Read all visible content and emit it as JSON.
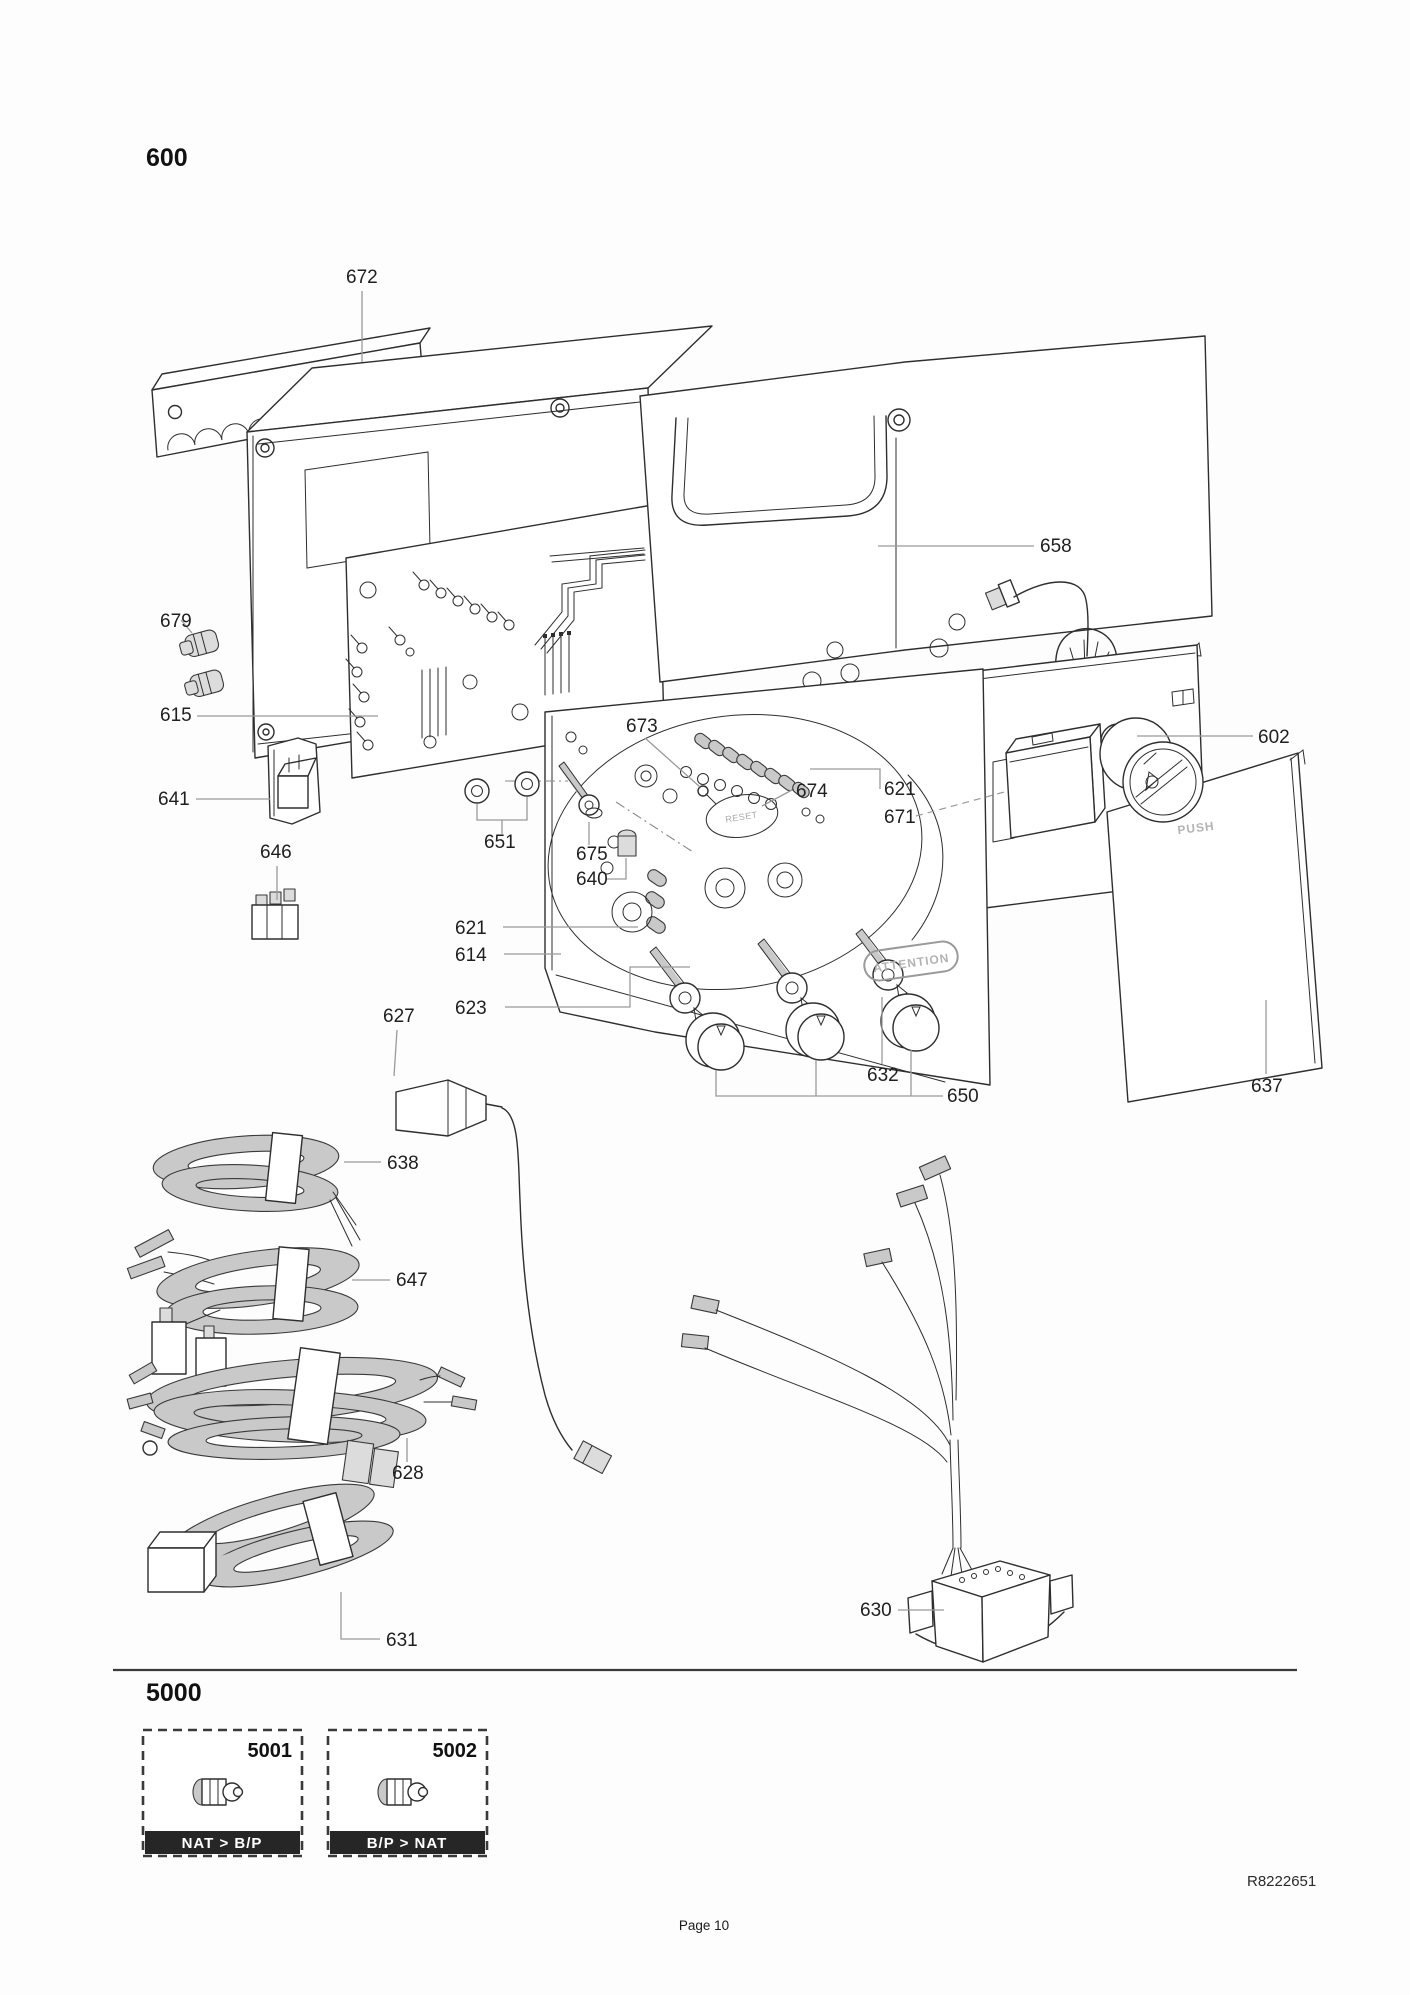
{
  "page": {
    "section_top": "600",
    "section_bottom": "5000",
    "doc_code": "R8222651",
    "page_label": "Page 10"
  },
  "diagram": {
    "push": "PUSH",
    "attention": "ATTENTION",
    "reset": "RESET",
    "parts": {
      "p602": "602",
      "p614": "614",
      "p615": "615",
      "p621": "621",
      "p623": "623",
      "p627": "627",
      "p628": "628",
      "p630": "630",
      "p631": "631",
      "p632": "632",
      "p637": "637",
      "p638": "638",
      "p640": "640",
      "p641": "641",
      "p646": "646",
      "p647": "647",
      "p650": "650",
      "p651": "651",
      "p658": "658",
      "p671": "671",
      "p672": "672",
      "p673": "673",
      "p674": "674",
      "p675": "675",
      "p679": "679"
    }
  },
  "kits": [
    {
      "number": "5001",
      "caption": "NAT > B/P"
    },
    {
      "number": "5002",
      "caption": "B/P > NAT"
    }
  ]
}
